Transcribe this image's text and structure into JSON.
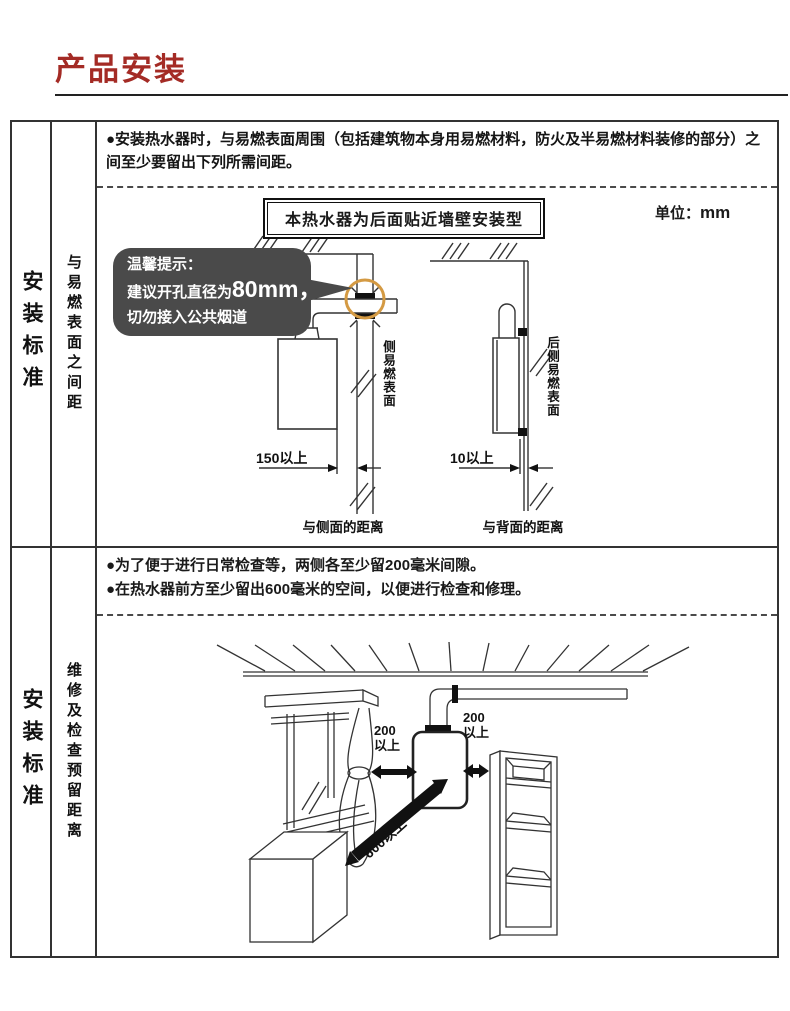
{
  "page": {
    "title": "产品安装"
  },
  "colors": {
    "title_red": "#a42b25",
    "tip_bg": "#4a4a4a",
    "highlight_circle": "#d49a43",
    "line": "#333333"
  },
  "section1": {
    "row_label": "安装标准",
    "sub_label": "与易燃表面之间距",
    "bullet": "●安装热水器时，与易燃表面周围（包括建筑物本身用易燃材料，防火及半易燃材料装修的部分）之间至少要留出下列所需间距。",
    "header_box": "本热水器为后面贴近墙壁安装型",
    "unit_label": "单位：",
    "unit_value": "mm",
    "tip": {
      "line1": "温馨提示：",
      "line2_prefix": "建议开孔直径为",
      "line2_big": "80mm，",
      "line3": "切勿接入公共烟道"
    },
    "left_diagram": {
      "wall_label": "侧易燃表面",
      "dimension": "150以上",
      "caption": "与侧面的距离"
    },
    "right_diagram": {
      "wall_label": "后侧易燃表面",
      "dimension": "10以上",
      "caption": "与背面的距离"
    }
  },
  "section2": {
    "row_label": "安装标准",
    "sub_label": "维修及检查预留距离",
    "bullets": [
      "●为了便于进行日常检查等，两侧各至少留200毫米间隙。",
      "●在热水器前方至少留出600毫米的空间，以便进行检查和修理。"
    ],
    "dimensions": {
      "left_side": "200以上",
      "right_side": "200以上",
      "front": "600以上"
    }
  }
}
